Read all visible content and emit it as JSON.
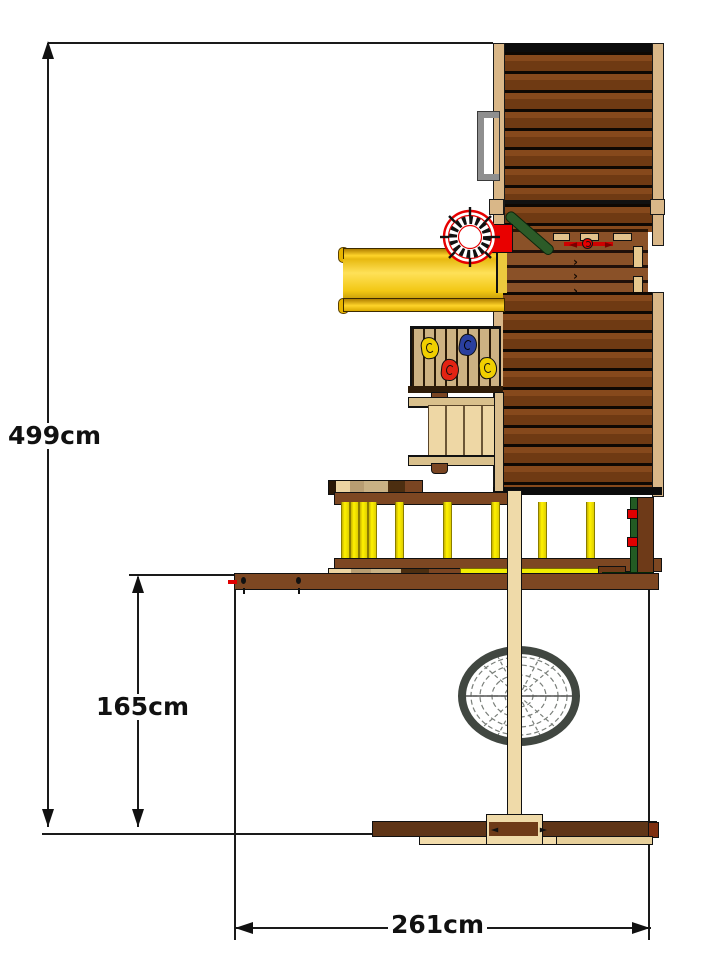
{
  "diagram": {
    "type": "product-dimension-drawing",
    "subject": "wooden climbing frame with slide and nest swing, side elevation",
    "dimensions": {
      "total_height": {
        "label": "499cm"
      },
      "platform_height": {
        "label": "165cm"
      },
      "base_width": {
        "label": "261cm"
      }
    },
    "deck": {
      "chevron_marks": [
        "›",
        "›",
        "›"
      ]
    },
    "colors": {
      "background": "#ffffff",
      "dimension_lines": "#1a1a1a",
      "roof_slat_brown": "#7a4318",
      "deck_brown": "#8a5128",
      "post_tan": "#d9b788",
      "slide_yellow": "#f6ce17",
      "railing_yellow": "#fff200",
      "pole_green": "#2c5b28",
      "accent_red": "#e60000",
      "nest_ring_gray": "#414741",
      "swing_post_tan": "#efdaa9"
    }
  }
}
